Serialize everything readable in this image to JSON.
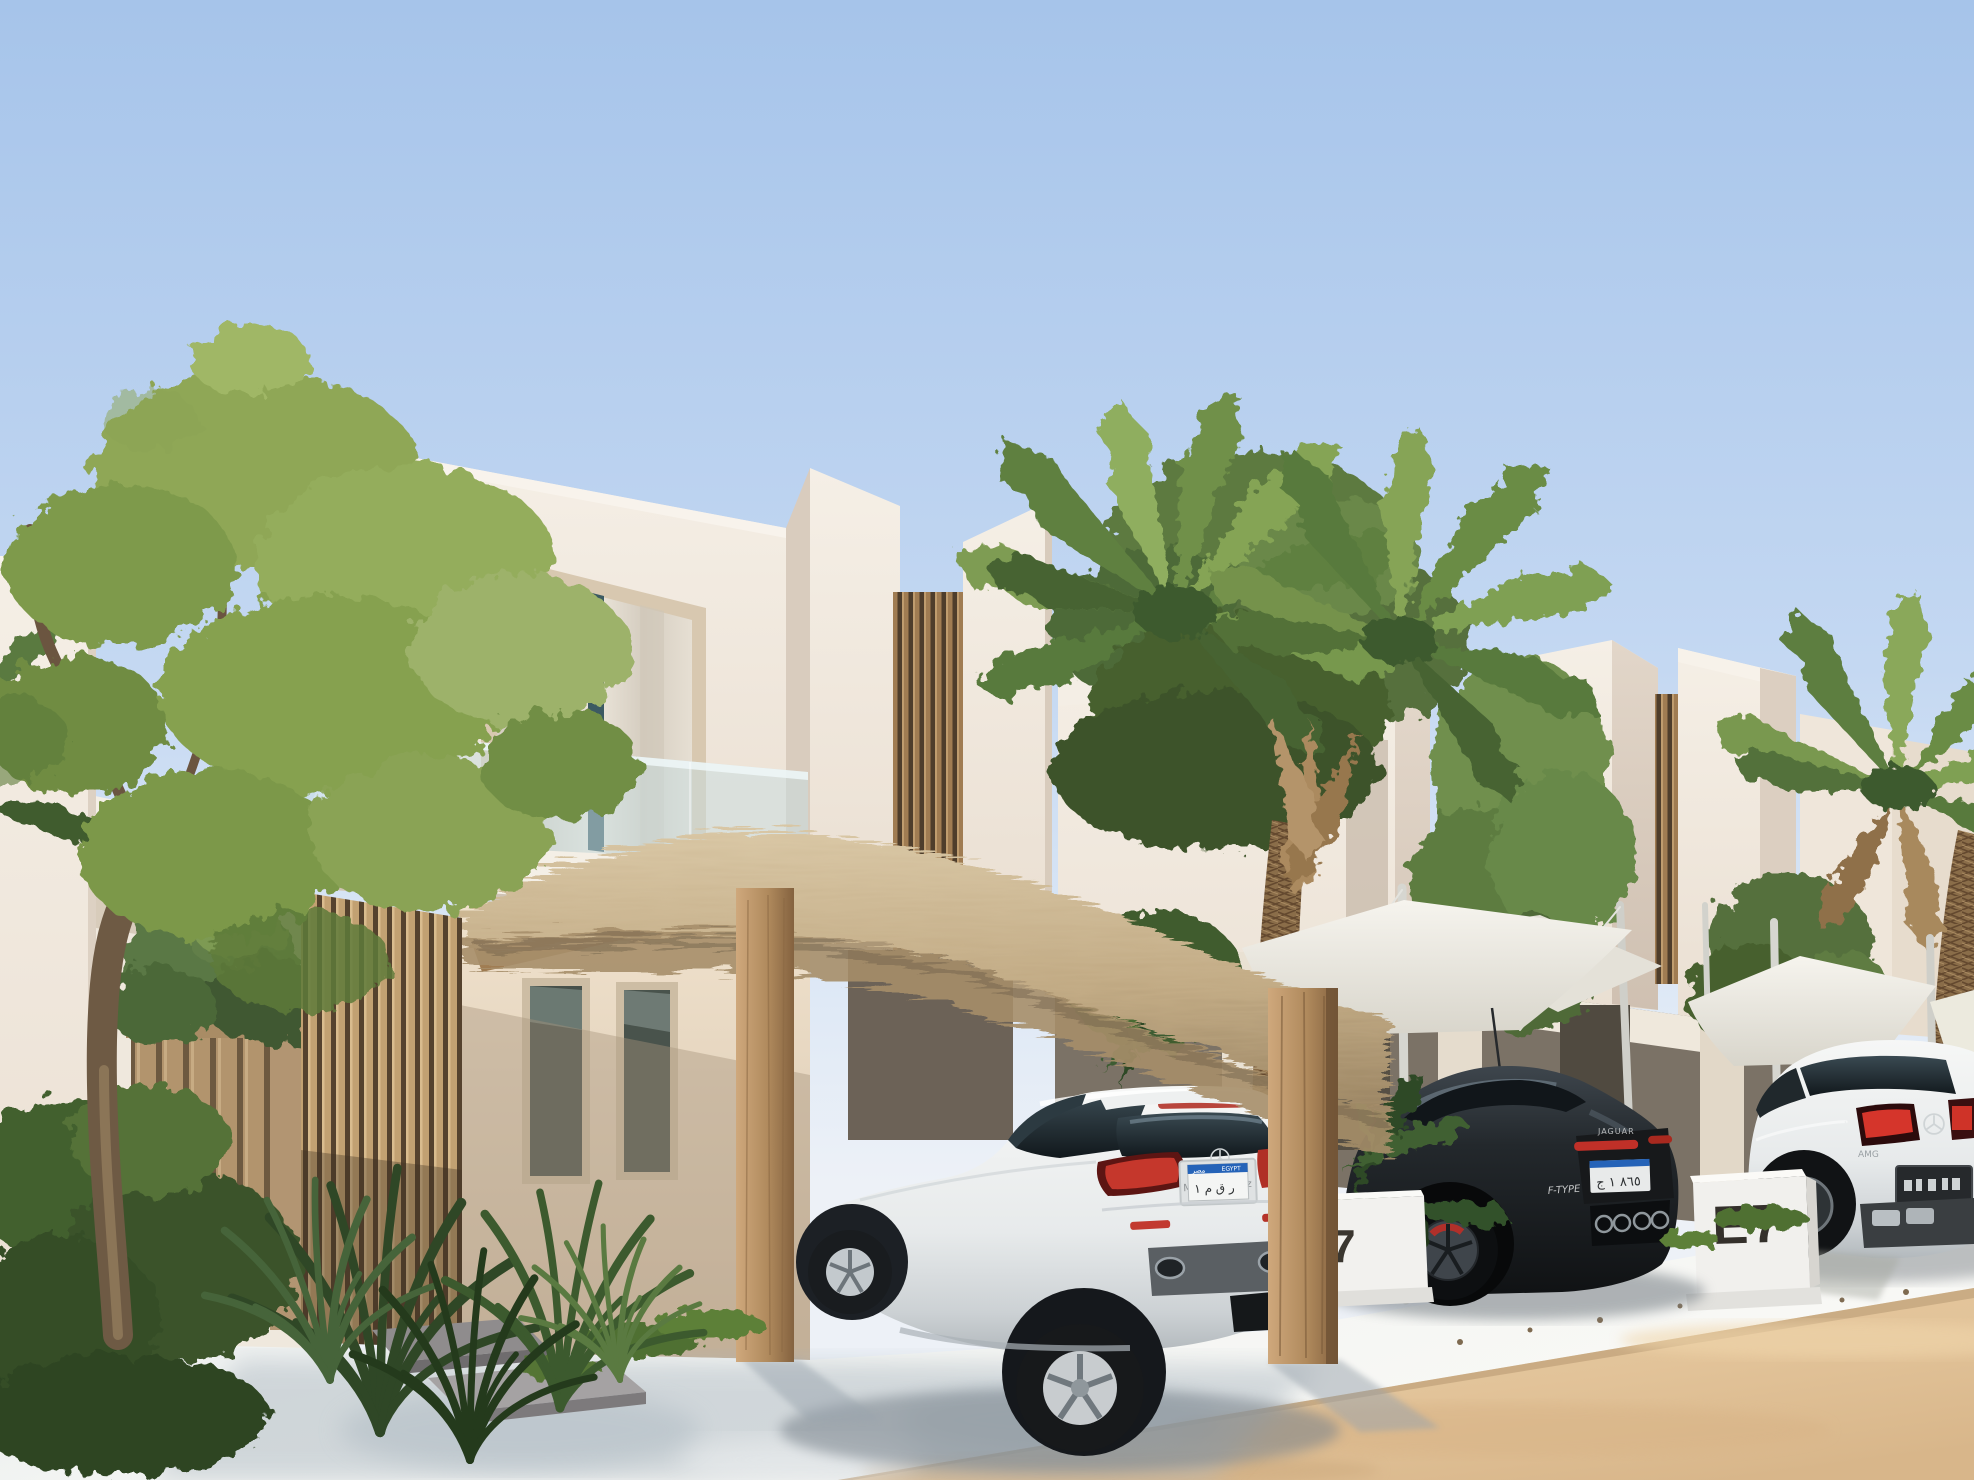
{
  "meta": {
    "kind": "architectural-exterior-rendering",
    "description": "Sunlit modern white beach villas with wooden slat accents, a palm-thatched carport, shade sails, three parked cars, palm trees and a sandy street"
  },
  "signs": {
    "villa_number_primary": "E7",
    "villa_number_partial": "7"
  },
  "vehicles": {
    "hatchback": {
      "body_color_name": "white",
      "license_plate": {
        "band_left": "مصر",
        "band_right": "EGYPT",
        "text": "ر ق م ١",
        "frame_text_left": "Me",
        "frame_text_right": "nz"
      }
    },
    "coupe": {
      "body_color_name": "dark grey",
      "badge_center": "JAGUAR",
      "badge_left": "F-TYPE",
      "license_plate": {
        "text": "٨٦٥ ١ ج"
      }
    },
    "suv": {
      "body_color_name": "white",
      "badge_left": "AMG"
    }
  },
  "palette": {
    "sky_top": "#a9c6eb",
    "sky_horizon": "#edf1f7",
    "wall_sunlit": "#f1eae1",
    "wall_shade": "#d9cdc0",
    "wood": "#b99368",
    "thatch": "#c9b48d",
    "foliage": "#7d9a4d",
    "palm": "#6f8f48",
    "pavement": "#f3f4f2",
    "sand": "#e5c99f",
    "plate_blue": "#2563b8",
    "tail_light_red": "#c5372c",
    "sign_text": "#34302b"
  }
}
